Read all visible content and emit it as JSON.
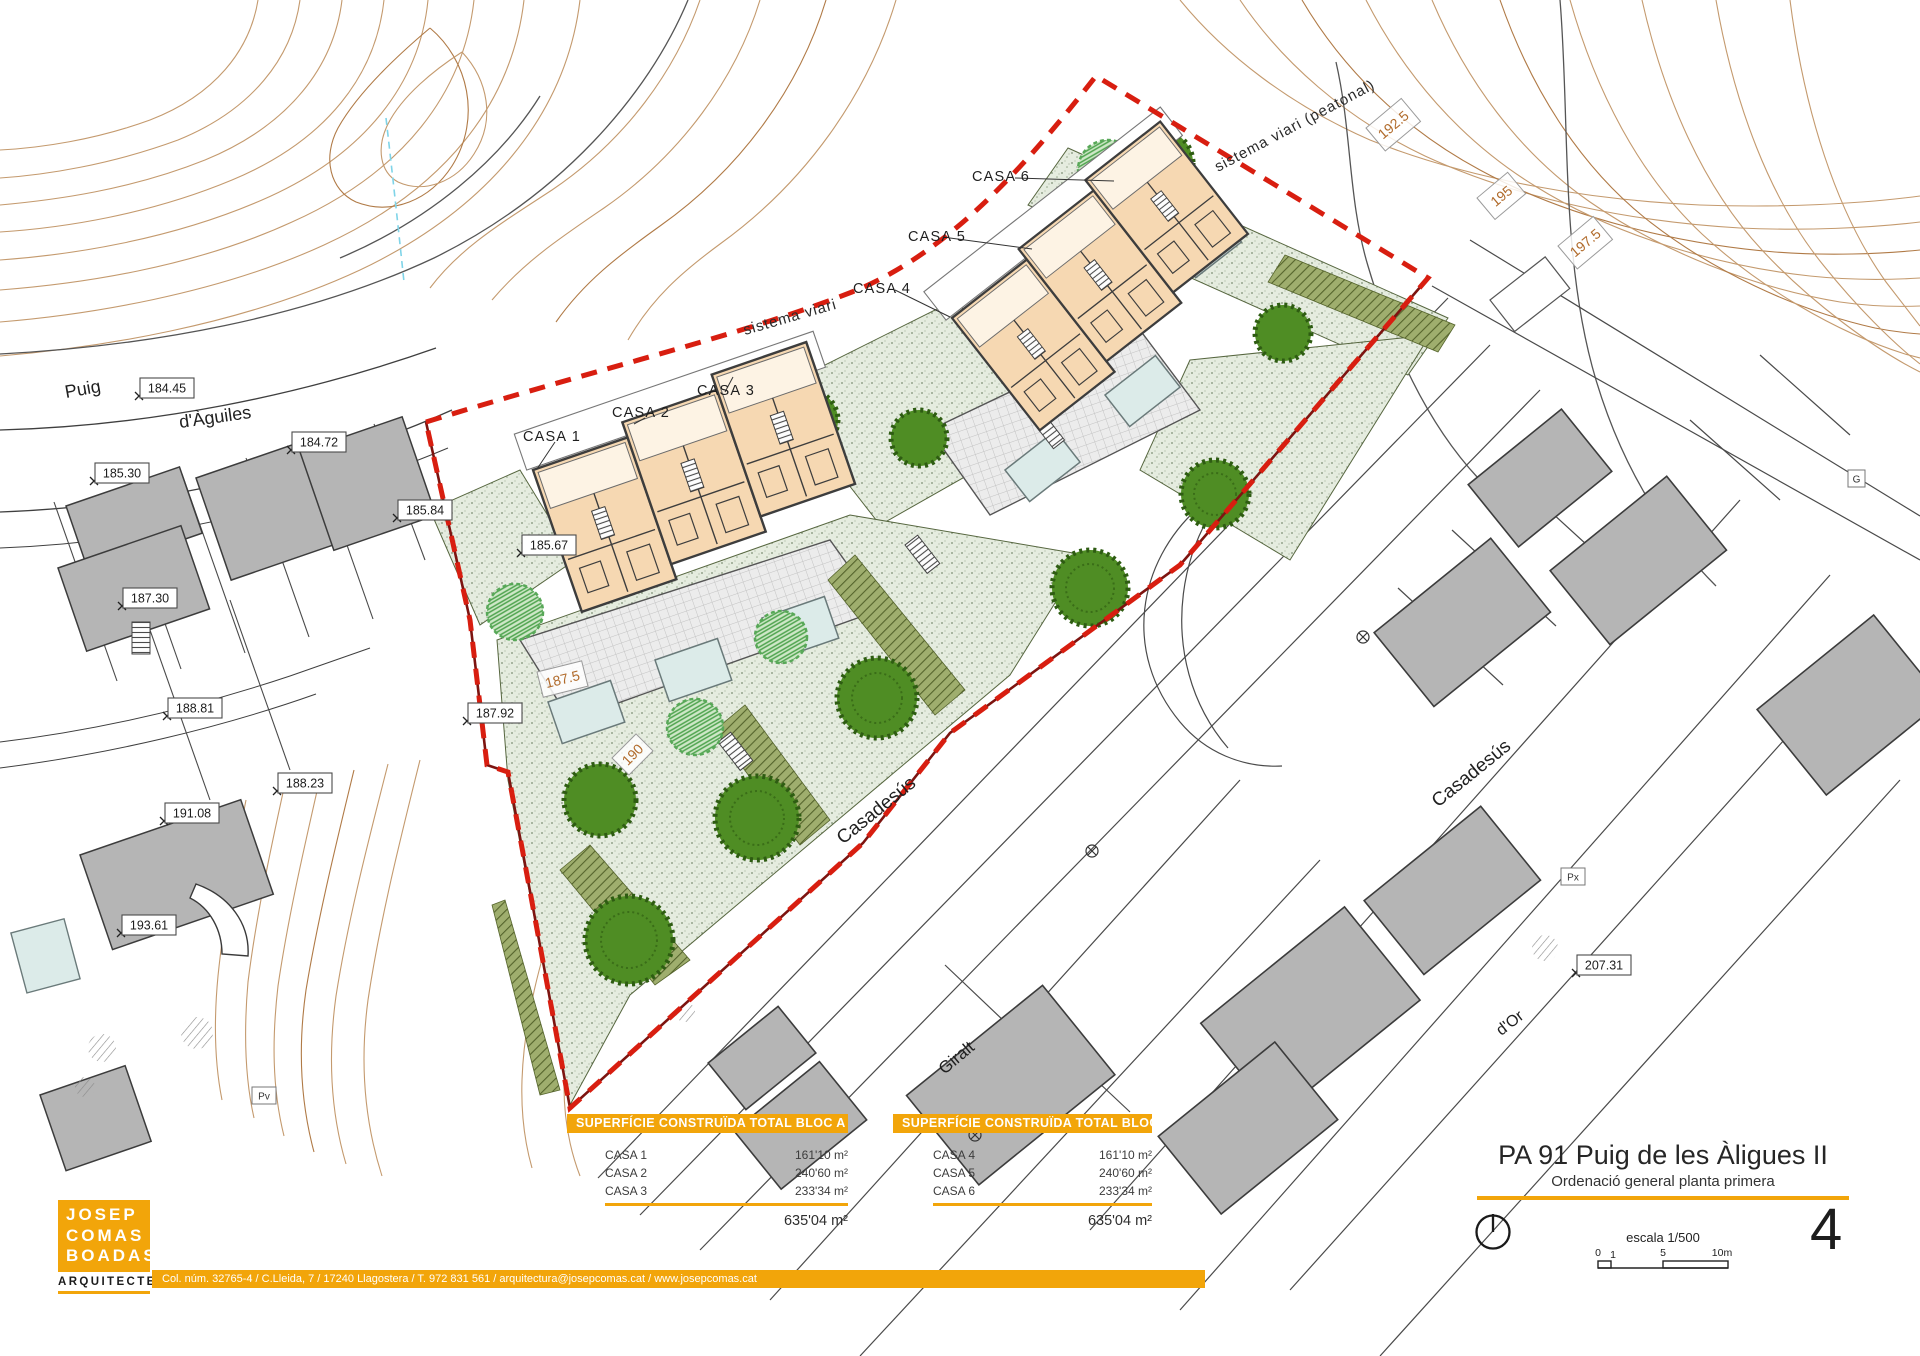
{
  "plan": {
    "casa_labels": [
      "CASA 1",
      "CASA 2",
      "CASA 3",
      "CASA 4",
      "CASA 5",
      "CASA 6"
    ],
    "system_labels": {
      "viari": "sistema viari",
      "viari_peatonal": "sistema viari (peatonal)"
    },
    "streets": {
      "puig": "Puig",
      "daguiles": "d'Àguiles",
      "casadesus": "Casadesús",
      "giralt": "Giralt",
      "dor": "d'Or"
    },
    "elevations": [
      "184.45",
      "184.72",
      "185.30",
      "185.84",
      "185.67",
      "187.30",
      "187.92",
      "188.81",
      "188.23",
      "191.08",
      "193.61",
      "207.31"
    ],
    "contour_labels": [
      "192.5",
      "195",
      "197.5",
      "187.5",
      "190"
    ],
    "small_boxes": {
      "pv": "Pv",
      "px": "Px",
      "g": "G"
    }
  },
  "tables": [
    {
      "title": "SUPERFÍCIE CONSTRUÏDA TOTAL BLOC A",
      "rows": [
        {
          "label": "CASA 1",
          "value": "161'10 m²"
        },
        {
          "label": "CASA 2",
          "value": "240'60 m²"
        },
        {
          "label": "CASA 3",
          "value": "233'34 m²"
        }
      ],
      "total": "635'04 m²"
    },
    {
      "title": "SUPERFÍCIE CONSTRUÏDA TOTAL BLOC B",
      "rows": [
        {
          "label": "CASA 4",
          "value": "161'10 m²"
        },
        {
          "label": "CASA 5",
          "value": "240'60 m²"
        },
        {
          "label": "CASA 6",
          "value": "233'34 m²"
        }
      ],
      "total": "635'04 m²"
    }
  ],
  "title_block": {
    "title": "PA 91 Puig de les Àligues II",
    "subtitle": "Ordenació general planta primera",
    "scale_label": "escala 1/500",
    "scale_ticks": [
      "0",
      "1",
      "5",
      "10m"
    ],
    "sheet_number": "4"
  },
  "logo": {
    "line1": "JOSEP",
    "line2": "COMAS",
    "line3": "BOADAS",
    "subtitle": "ARQUITECTE"
  },
  "footer": {
    "text": "Col. núm. 32765-4 / C.Lleida, 7 / 17240 Llagostera / T. 972 831 561 / arquitectura@josepcomas.cat / www.josepcomas.cat"
  },
  "colors": {
    "accent_orange": "#F2A50A",
    "boundary_red": "#D81E10",
    "building_peach": "#F6D8B2",
    "existing_gray": "#B5B5B5",
    "garden_green": "#E5ECDF",
    "tree_green": "#4A8A22",
    "contour_tan": "#C49A6E",
    "pool_blue": "#DCEBE9"
  }
}
